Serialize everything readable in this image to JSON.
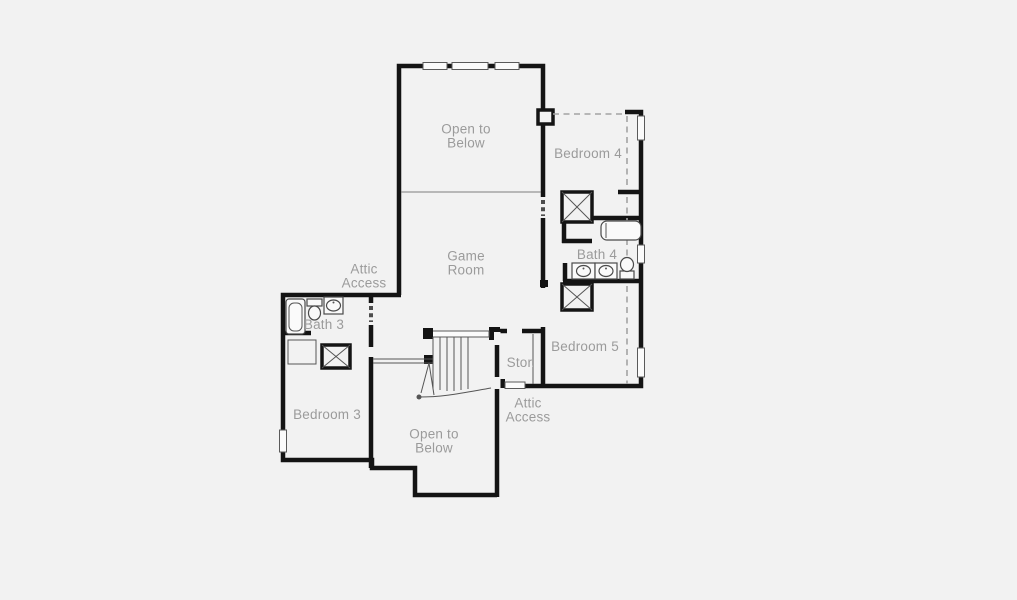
{
  "colors": {
    "background": "#f2f2f2",
    "wall": "#141414",
    "label": "#9b9b9b",
    "dash": "#a3a3a3"
  },
  "rooms": {
    "open_to_below_top": "Open to\nBelow",
    "bedroom_4": "Bedroom 4",
    "game_room": "Game\nRoom",
    "bath_4": "Bath 4",
    "bedroom_5": "Bedroom 5",
    "attic_access_left": "Attic\nAccess",
    "bath_3": "Bath 3",
    "storage": "Stor.",
    "bedroom_3": "Bedroom 3",
    "attic_access_right": "Attic\nAccess",
    "open_to_below_bottom": "Open to\nBelow"
  }
}
